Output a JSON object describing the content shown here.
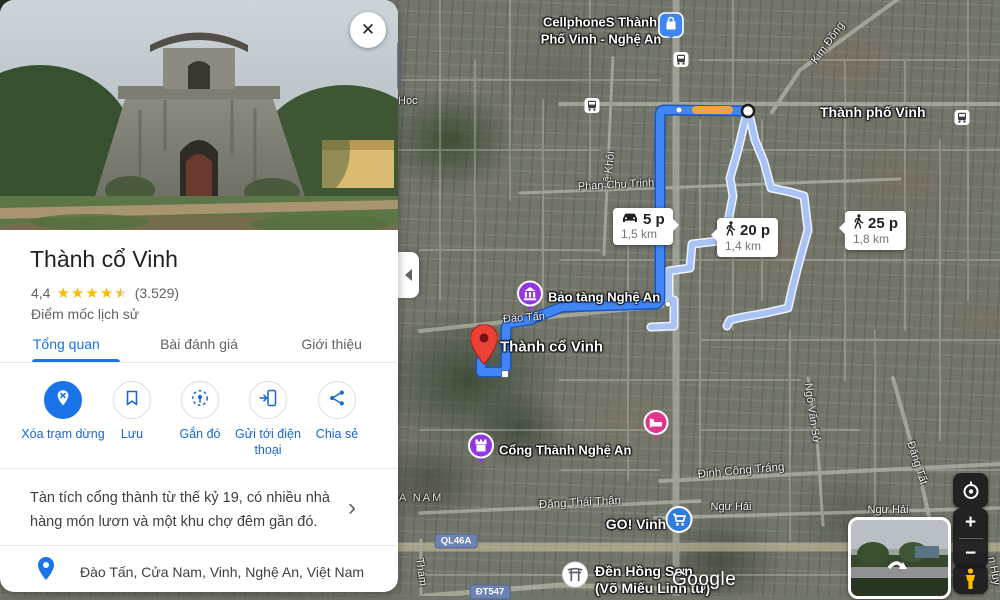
{
  "panel": {
    "title": "Thành cổ Vinh",
    "rating": {
      "value": "4,4",
      "count": "(3.529)"
    },
    "category": "Điểm mốc lịch sử",
    "tabs": [
      {
        "label": "Tổng quan"
      },
      {
        "label": "Bài đánh giá"
      },
      {
        "label": "Giới thiệu"
      }
    ],
    "actions": [
      {
        "label": "Xóa trạm dừng"
      },
      {
        "label": "Lưu"
      },
      {
        "label": "Gắn đó"
      },
      {
        "label": "Gửi tới điện thoại"
      },
      {
        "label": "Chia sẻ"
      }
    ],
    "description": "Tàn tích cổng thành từ thế kỷ 19, có nhiều nhà hàng món lươn và một khu chợ đêm gần đó.",
    "address": "Đào Tấn, Cửa Nam, Vinh, Nghệ An, Việt Nam"
  },
  "map": {
    "origin": {
      "label": "Thành phố Vinh"
    },
    "destination": {
      "label": "Thành cổ Vinh"
    },
    "routes": [
      {
        "mode": "drive",
        "duration": "5 p",
        "distance": "1,5 km"
      },
      {
        "mode": "walk",
        "duration": "20 p",
        "distance": "1,4 km"
      },
      {
        "mode": "walk",
        "duration": "25 p",
        "distance": "1,8 km"
      }
    ],
    "pois": {
      "cellphones": {
        "line1": "CellphoneS Thành",
        "line2": "Phố Vinh - Nghệ An"
      },
      "museum": "Bảo tàng Nghệ An",
      "citadel_gate": "Cổng Thành Nghệ An",
      "go_vinh": "GO! Vinh",
      "temple": {
        "line1": "Đền Hồng Sơn",
        "line2": "(Võ Miếu Linh từ)"
      }
    },
    "streets": [
      {
        "text": "Học"
      },
      {
        "text": "Lê Khôi"
      },
      {
        "text": "Phan Chu Trinh"
      },
      {
        "text": "Đào Tấn"
      },
      {
        "text": "Kim Đồng"
      },
      {
        "text": "Ngô Văn Sở"
      },
      {
        "text": "Đặng Tất"
      },
      {
        "text": "Đinh Công Tráng"
      },
      {
        "text": "Đặng Thái Thân"
      },
      {
        "text": "Ngư Hải"
      },
      {
        "text": "Ngư Hải"
      },
      {
        "text": "A NAM"
      },
      {
        "text": "Thám"
      },
      {
        "text": "n Huy"
      }
    ],
    "badges": [
      {
        "text": "QL46A"
      },
      {
        "text": "ĐT547"
      }
    ],
    "attribution": "Google"
  },
  "controls": {
    "zoom_in": "+",
    "zoom_out": "−"
  },
  "icons": {
    "close": "✕",
    "star": "★",
    "chevron_right": "›"
  },
  "colors": {
    "accent": "#1a73e8",
    "route": "#4285f4",
    "route_alt": "#a9c3f7",
    "traffic": "#f2a43c",
    "star": "#fbbc04",
    "pin_red": "#ea4335"
  }
}
